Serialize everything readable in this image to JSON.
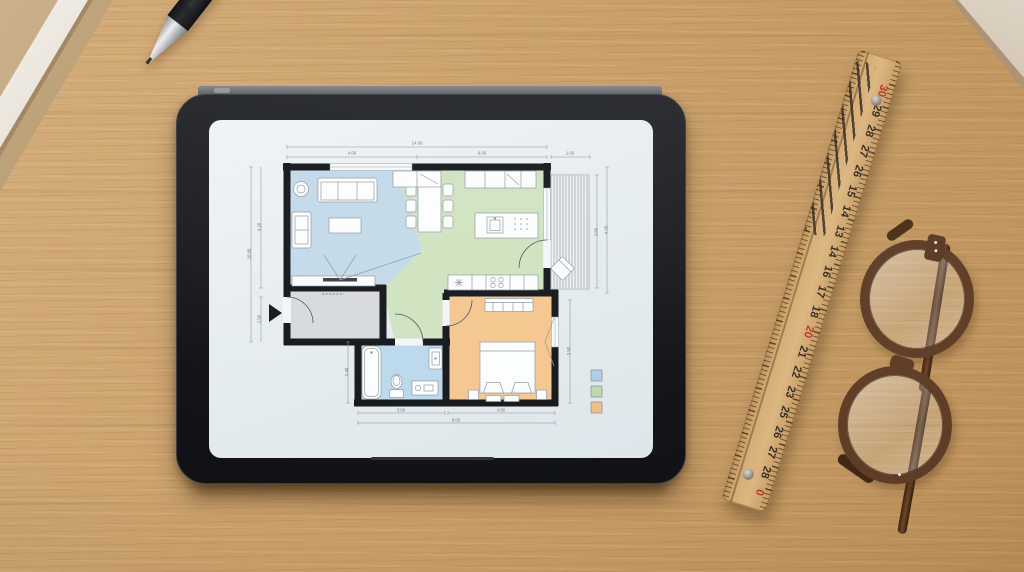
{
  "colors": {
    "wood": "#c89e68",
    "tablet_frame": "#17191d",
    "screen": "#e9eff2",
    "wall": "#14171b",
    "ruler_wood": "#cfa66e",
    "ruler_red": "#b5372a",
    "glasses_frame": "#5e3d26",
    "pen": "#141518"
  },
  "floor_plan": {
    "rooms": {
      "living": {
        "color": "#c3daea"
      },
      "kitchen_dining": {
        "color": "#cfe3c1"
      },
      "hallway": {
        "color": "#d6dadd"
      },
      "bathroom": {
        "color": "#bad9ec"
      },
      "bedroom": {
        "color": "#f4c78e"
      },
      "terrace": {
        "color": "#eef2f4"
      }
    },
    "dimensions": {
      "top_total": "14.00",
      "top_left": "4.00",
      "top_right": "6.00",
      "terrace_width": "1.60",
      "left_total": "10.60",
      "left_upper": "4.20",
      "left_lower": "1.50",
      "right_inner": "3.80",
      "right_outer": "4.20",
      "bedroom_right": "3.50",
      "bath_left": "2.40",
      "bottom_bath": "3.00",
      "bottom_bed": "4.60",
      "bottom_total": "8.00"
    },
    "legend": [
      {
        "color": "#aecde4"
      },
      {
        "color": "#bdd8ae"
      },
      {
        "color": "#f2bd80"
      }
    ]
  },
  "ruler": {
    "numbers": [
      {
        "value": "30",
        "red": true
      },
      {
        "value": "29",
        "red": false
      },
      {
        "value": "28",
        "red": false
      },
      {
        "value": "27",
        "red": false
      },
      {
        "value": "26",
        "red": false
      },
      {
        "value": "15",
        "red": false
      },
      {
        "value": "14",
        "red": false
      },
      {
        "value": "13",
        "red": false
      },
      {
        "value": "14",
        "red": false
      },
      {
        "value": "16",
        "red": false
      },
      {
        "value": "17",
        "red": false
      },
      {
        "value": "18",
        "red": false
      },
      {
        "value": "20",
        "red": true
      },
      {
        "value": "21",
        "red": false
      },
      {
        "value": "22",
        "red": false
      },
      {
        "value": "23",
        "red": false
      },
      {
        "value": "25",
        "red": false
      },
      {
        "value": "26",
        "red": false
      },
      {
        "value": "27",
        "red": false
      },
      {
        "value": "28",
        "red": false
      },
      {
        "value": "0",
        "red": true
      }
    ]
  }
}
